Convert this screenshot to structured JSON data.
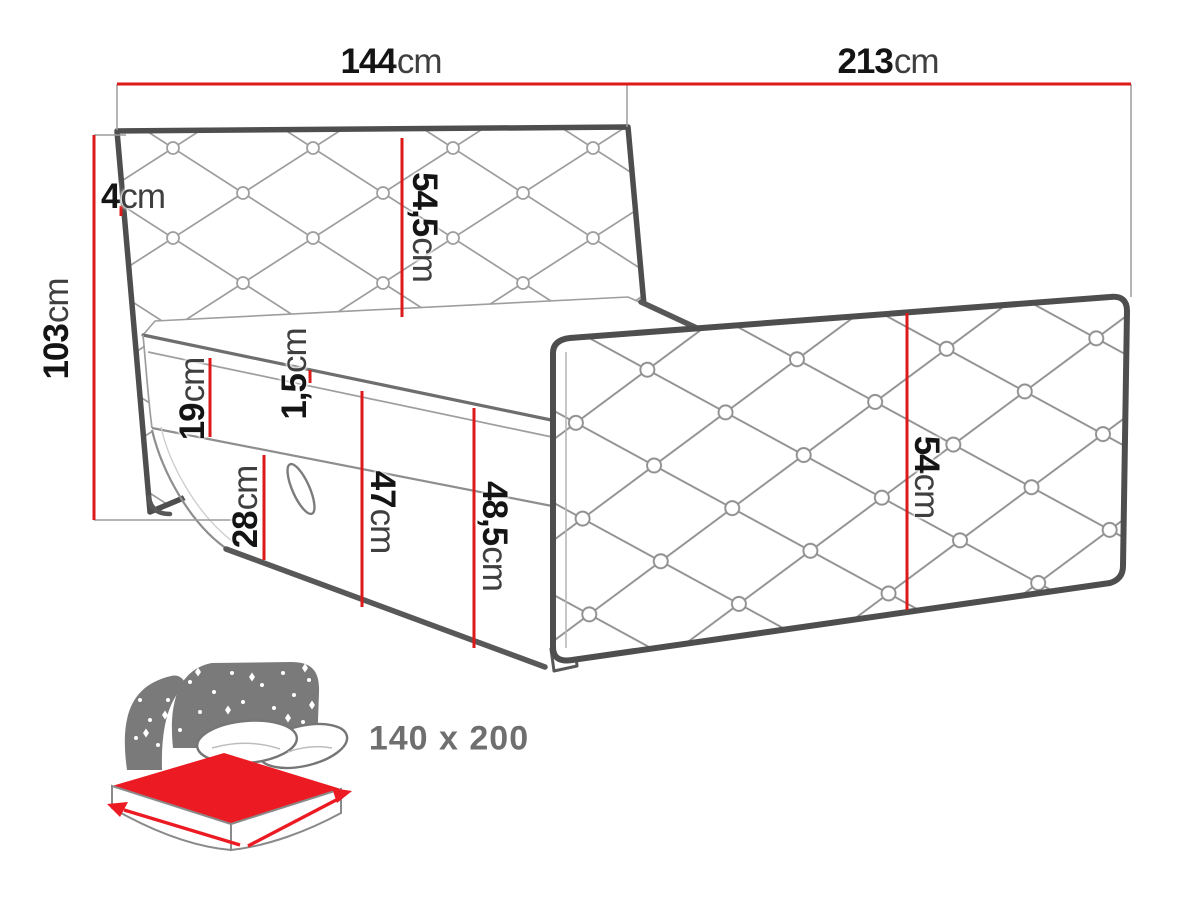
{
  "dimensions": {
    "headboard_width": {
      "value": "144",
      "unit": "cm"
    },
    "bed_length": {
      "value": "213",
      "unit": "cm"
    },
    "headboard_top_thickness": {
      "value": "4",
      "unit": "cm"
    },
    "total_height": {
      "value": "103",
      "unit": "cm"
    },
    "headboard_above_mattress": {
      "value": "54,5",
      "unit": "cm"
    },
    "mattress_height": {
      "value": "19",
      "unit": "cm"
    },
    "mattress_welt": {
      "value": "1,5",
      "unit": "cm"
    },
    "base_height": {
      "value": "28",
      "unit": "cm"
    },
    "side_height_welt_to_floor": {
      "value": "47",
      "unit": "cm"
    },
    "side_height_total": {
      "value": "48,5",
      "unit": "cm"
    },
    "footboard_height": {
      "value": "54",
      "unit": "cm"
    }
  },
  "icon_badge": {
    "size_text": "140 x 200"
  },
  "icons": [
    "bed-size-icon",
    "starry-headboard-icon",
    "mattress-icon",
    "pillows-icon",
    "width-arrow-icon",
    "length-arrow-icon"
  ],
  "colors": {
    "dimension_red": "#dd1a1a",
    "drawing_outline": "#4e4e4e",
    "icon_gray": "#7a7a7a",
    "icon_red": "#ec1b23",
    "number_color": "#141414",
    "unit_color": "#3f3f3f",
    "size_text_color": "#6f6f6f"
  }
}
